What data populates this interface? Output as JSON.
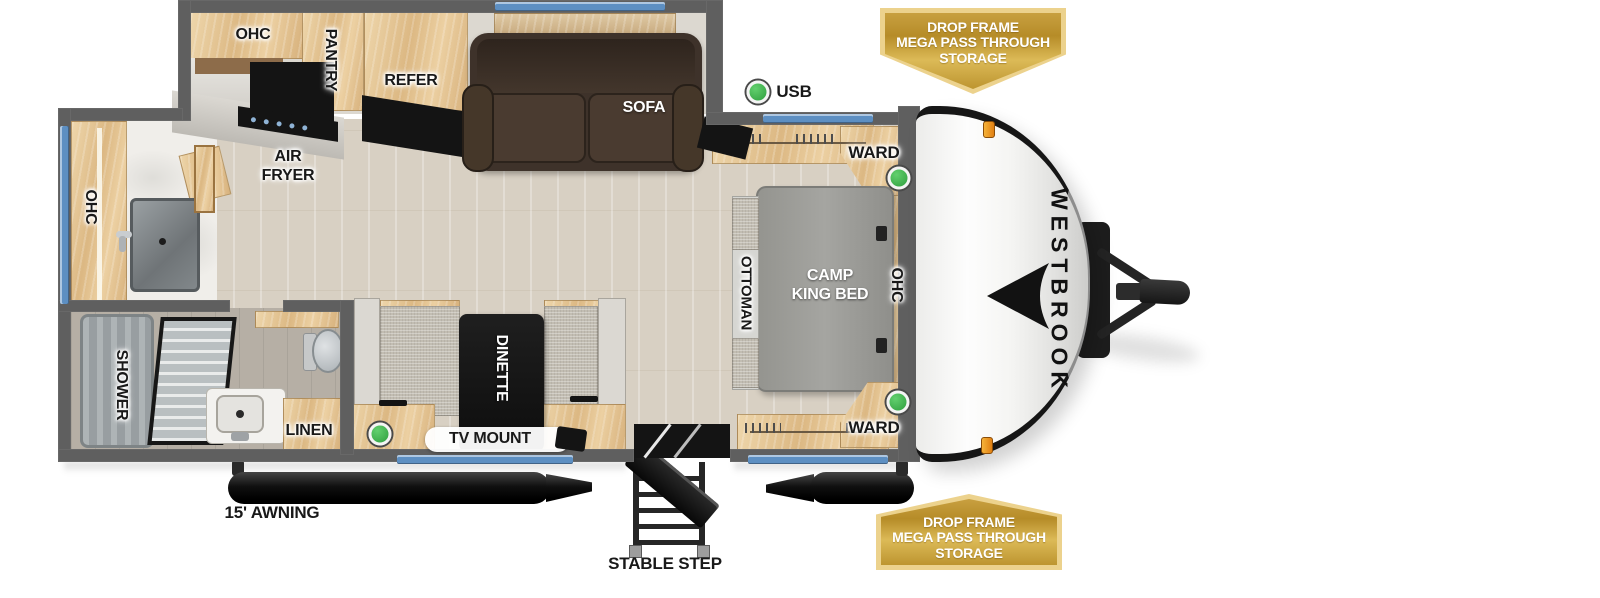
{
  "brand": {
    "logo": "WESTBROOK"
  },
  "badge": {
    "line1": "DROP FRAME",
    "line2": "MEGA PASS THROUGH",
    "line3": "STORAGE"
  },
  "kitchen": {
    "ohc": "OHC",
    "pantry": "PANTRY",
    "refer": "REFER",
    "air_fryer_line1": "AIR",
    "air_fryer_line2": "FRYER"
  },
  "living": {
    "sofa": "SOFA",
    "usb": "USB",
    "dinette": "DINETTE",
    "tv_mount": "TV MOUNT"
  },
  "bedroom": {
    "ward_top": "WARD",
    "ward_bottom": "WARD",
    "ottoman": "OTTOMAN",
    "bed_line1": "CAMP",
    "bed_line2": "KING BED",
    "ohc": "OHC"
  },
  "bathroom": {
    "ohc": "OHC",
    "shower": "SHOWER",
    "linen": "LINEN"
  },
  "exterior": {
    "awning": "15' AWNING",
    "stable_step": "STABLE STEP"
  },
  "colors": {
    "indicator_green": "#3cb54b",
    "window_blue": "#5d8fc2",
    "badge_gold": "#c49d38",
    "wall_gray": "#5f5f5f"
  }
}
